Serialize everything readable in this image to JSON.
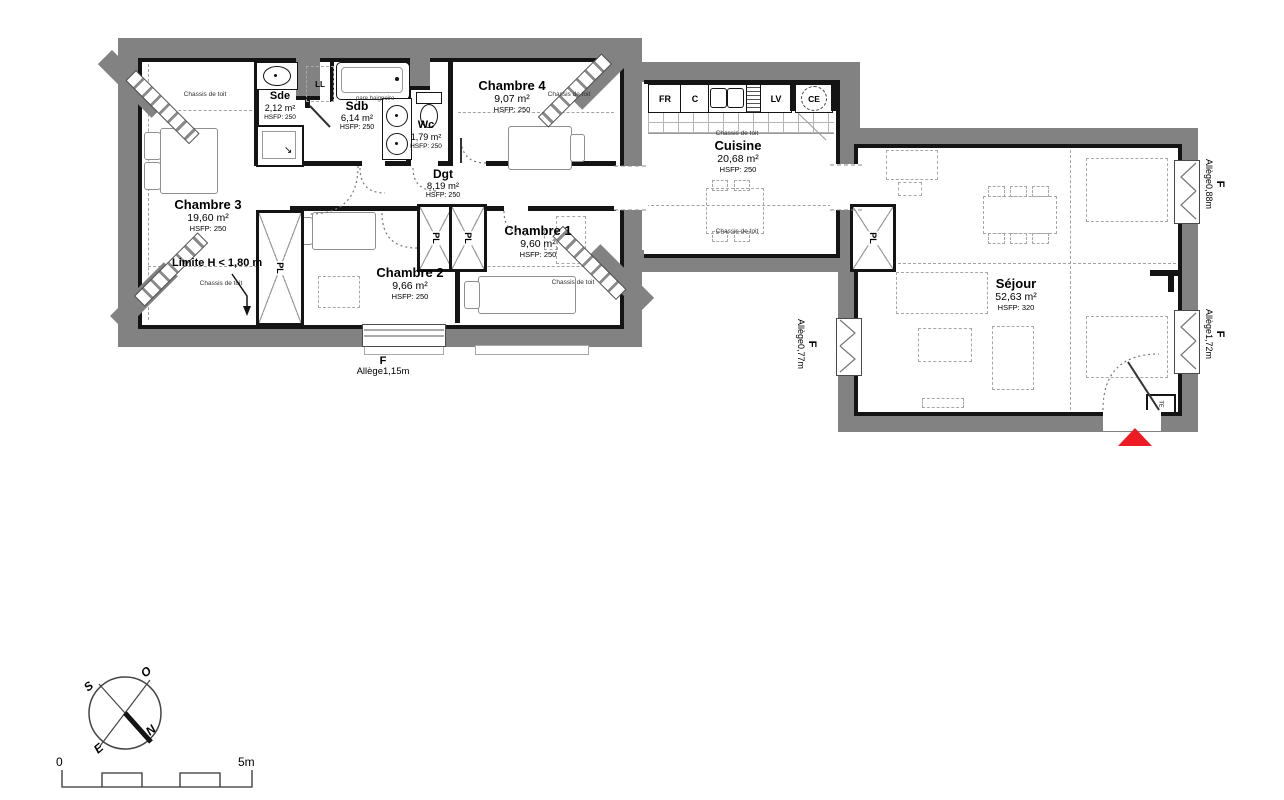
{
  "rooms": {
    "chambre3": {
      "name": "Chambre 3",
      "area": "19,60 m²",
      "hsfp": "HSFP: 250"
    },
    "sde": {
      "name": "Sde",
      "area": "2,12 m²",
      "hsfp": "HSFP: 250"
    },
    "sdb": {
      "name": "Sdb",
      "area": "6,14 m²",
      "hsfp": "HSFP: 250"
    },
    "wc": {
      "name": "Wc",
      "area": "1,79 m²",
      "hsfp": "HSFP: 250"
    },
    "dgt": {
      "name": "Dgt",
      "area": "8,19 m²",
      "hsfp": "HSFP: 250"
    },
    "chambre4": {
      "name": "Chambre 4",
      "area": "9,07 m²",
      "hsfp": "HSFP: 250"
    },
    "chambre1": {
      "name": "Chambre 1",
      "area": "9,60 m²",
      "hsfp": "HSFP: 250"
    },
    "chambre2": {
      "name": "Chambre 2",
      "area": "9,66 m²",
      "hsfp": "HSFP: 250"
    },
    "cuisine": {
      "name": "Cuisine",
      "area": "20,68 m²",
      "hsfp": "HSFP: 250"
    },
    "sejour": {
      "name": "Séjour",
      "area": "52,63 m²",
      "hsfp": "HSFP: 320"
    }
  },
  "annotations": {
    "chassis_de_toit": "Chassis de toit",
    "limite": "Limite H < 1,80 m",
    "pare_baignoire": "pare baignoire",
    "pl": "PL",
    "ll": "LL",
    "te": "TE"
  },
  "appliances": {
    "fr": "FR",
    "c": "C",
    "lv": "LV",
    "ce": "CE"
  },
  "windows": {
    "south": {
      "f": "F",
      "allege": "Allège1,15m"
    },
    "east_top": {
      "f": "F",
      "allege": "Allège0,88m"
    },
    "east_bottom": {
      "f": "F",
      "allege": "Allège1,72m"
    },
    "west": {
      "f": "F",
      "allege": "Allège0,77m"
    }
  },
  "compass": {
    "n": "N",
    "s": "S",
    "e": "E",
    "o": "O"
  },
  "scalebar": {
    "start": "0",
    "end": "5m"
  },
  "colors": {
    "wall": "#828282",
    "accent_red": "#ed1c24"
  }
}
